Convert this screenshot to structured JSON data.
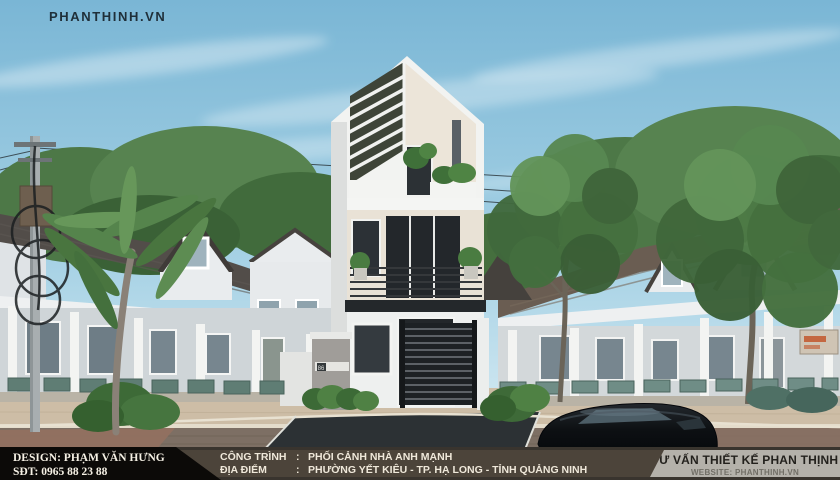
{
  "watermark": {
    "text": "PHANTHINH.VN"
  },
  "scene": {
    "house_number": "86",
    "colors": {
      "sky_top": "#7ab6d5",
      "sky_horizon": "#d9ecf4",
      "roof_left": "#524d49",
      "roof_right": "#6a5d52",
      "wall_white": "#eceff0",
      "hero_wall": "#ece5d9",
      "foliage": "#4c7a45",
      "road_brick": "#7d6f64",
      "asphalt": "#2c3134",
      "car_black": "#0d1013",
      "footer_left_bg": "#0c0a08",
      "footer_center_bg": "#4c443a",
      "footer_right_bg": "#b4b1aa"
    }
  },
  "footer": {
    "left": {
      "line1": "DESIGN: PHẠM VĂN HƯNG",
      "line2": "SĐT: 0965 88 23 88"
    },
    "center": {
      "rows": [
        {
          "label": "CÔNG TRÌNH",
          "sep": ":",
          "value": "PHỐI CẢNH NHÀ ANH MẠNH"
        },
        {
          "label": "ĐỊA ĐIỂM",
          "sep": ":",
          "value": "PHƯỜNG YẾT KIÊU - TP. HẠ LONG - TỈNH QUẢNG NINH"
        }
      ]
    },
    "right": {
      "title": "TƯ VẤN THIẾT KẾ PHAN THỊNH",
      "website": "WEBSITE: PHANTHINH.VN"
    }
  }
}
